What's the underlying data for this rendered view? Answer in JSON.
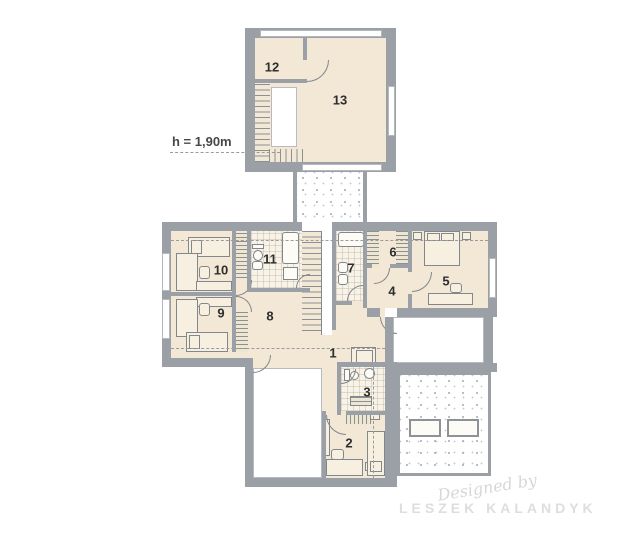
{
  "annotation": {
    "height_label": "h = 1,90m"
  },
  "rooms": {
    "r1": "1",
    "r2": "2",
    "r3": "3",
    "r4": "4",
    "r5": "5",
    "r6": "6",
    "r7": "7",
    "r8": "8",
    "r9": "9",
    "r10": "10",
    "r11": "11",
    "r12": "12",
    "r13": "13"
  },
  "watermark": {
    "line1": "Designed by",
    "line2": "LESZEK KALANDYK"
  },
  "colors": {
    "wall": "#9aa0a5",
    "floor": "#f2e8d5",
    "bath_floor": "#f8f3e8",
    "furniture_line": "#82878c",
    "dash": "#9b9b9b",
    "watermark": "#dcdcdc"
  }
}
